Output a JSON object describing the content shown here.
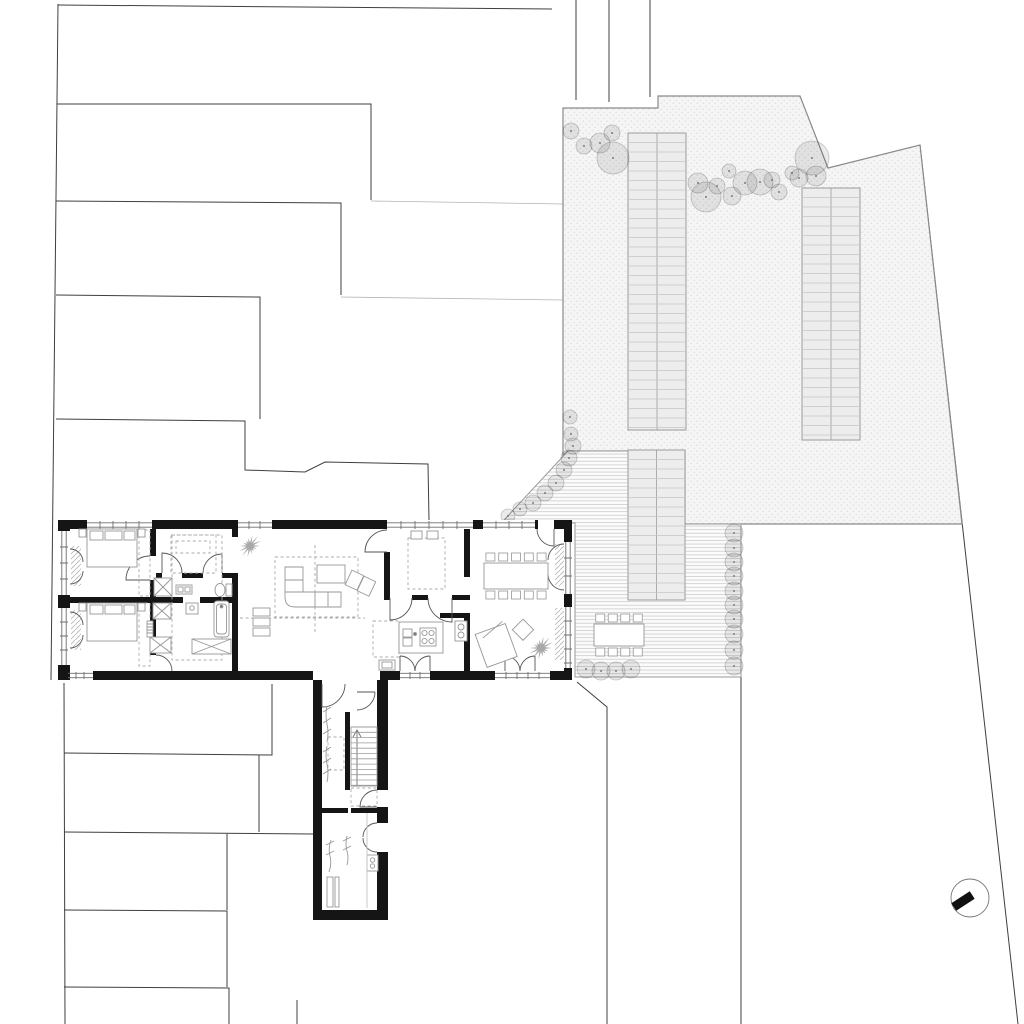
{
  "canvas": {
    "width": 1024,
    "height": 1024,
    "background": "#ffffff"
  },
  "palette": {
    "paper": "#ffffff",
    "wall": "#151515",
    "site_line": "#3f3f3f",
    "detail": "#979797",
    "dashed": "#ababab",
    "window": "#6e6e6e",
    "door": "#555555",
    "stipple_bg": "#f5f5f5",
    "stipple_dot": "#dadada",
    "deck_bg": "#fbfbfb",
    "deck_line": "#d2d2d2",
    "bed_fill": "#ededed",
    "bed_line": "#9b9b9b",
    "bed_rung": "#c4c4c4",
    "tree_fill": "rgba(0,0,0,0.08)",
    "tree_stroke": "rgba(0,0,0,0.22)",
    "tree_dot": "#7d7d7d",
    "plant": "#9a9a9a",
    "north": "#111111"
  },
  "site": {
    "lines": [
      [
        [
          58,
          4
        ],
        [
          51,
          680
        ]
      ],
      [
        [
          64,
          683
        ],
        [
          65,
          1024
        ]
      ],
      [
        [
          58,
          5
        ],
        [
          552,
          9
        ]
      ],
      [
        [
          576,
          0
        ],
        [
          576,
          100
        ]
      ],
      [
        [
          609,
          0
        ],
        [
          609,
          102
        ]
      ],
      [
        [
          650,
          0
        ],
        [
          650,
          97
        ]
      ],
      [
        [
          57,
          104
        ],
        [
          371,
          104
        ],
        [
          371,
          200
        ]
      ],
      [
        [
          56,
          201
        ],
        [
          341,
          203
        ],
        [
          341,
          295
        ]
      ],
      [
        [
          56,
          295
        ],
        [
          260,
          297
        ],
        [
          260,
          419
        ]
      ],
      [
        [
          56,
          419
        ],
        [
          245,
          421
        ],
        [
          245,
          470
        ],
        [
          305,
          472
        ],
        [
          325,
          462
        ],
        [
          428,
          464
        ],
        [
          429,
          520
        ]
      ],
      [
        [
          272,
          684
        ],
        [
          272,
          755
        ],
        [
          64,
          753
        ]
      ],
      [
        [
          259,
          755
        ],
        [
          259,
          832
        ]
      ],
      [
        [
          64,
          832
        ],
        [
          313,
          834
        ]
      ],
      [
        [
          227,
          834
        ],
        [
          227,
          910
        ]
      ],
      [
        [
          64,
          910
        ],
        [
          227,
          911
        ],
        [
          227,
          987
        ]
      ],
      [
        [
          64,
          987
        ],
        [
          229,
          988
        ],
        [
          229,
          1024
        ]
      ],
      [
        [
          297,
          1000
        ],
        [
          297,
          1024
        ]
      ],
      [
        [
          577,
          682
        ],
        [
          607,
          707
        ],
        [
          607,
          1024
        ]
      ],
      [
        [
          741,
          525
        ],
        [
          741,
          1024
        ]
      ],
      [
        [
          920,
          145
        ],
        [
          1018,
          1024
        ]
      ]
    ],
    "faint_lines": [
      [
        [
          371,
          201
        ],
        [
          563,
          204
        ]
      ],
      [
        [
          341,
          297
        ],
        [
          563,
          300
        ]
      ]
    ]
  },
  "garden": {
    "outline": [
      [
        563,
        455
      ],
      [
        563,
        108
      ],
      [
        658,
        108
      ],
      [
        658,
        96
      ],
      [
        800,
        96
      ],
      [
        828,
        168
      ],
      [
        920,
        145
      ],
      [
        962,
        524
      ],
      [
        741,
        524
      ],
      [
        685,
        524
      ],
      [
        685,
        451
      ],
      [
        568,
        451
      ]
    ],
    "beds": [
      {
        "x": 628,
        "y": 133,
        "w": 58,
        "h": 297
      },
      {
        "x": 802,
        "y": 188,
        "w": 58,
        "h": 252
      },
      {
        "x": 628,
        "y": 450,
        "w": 57,
        "h": 150
      }
    ],
    "rung_gap": 9.5,
    "trees": [
      [
        571,
        131,
        8
      ],
      [
        584,
        146,
        8
      ],
      [
        600,
        143,
        10
      ],
      [
        612,
        133,
        8
      ],
      [
        613,
        158,
        16
      ],
      [
        698,
        183,
        10
      ],
      [
        706,
        197,
        15
      ],
      [
        717,
        186,
        8
      ],
      [
        729,
        171,
        7
      ],
      [
        732,
        196,
        9
      ],
      [
        745,
        183,
        12
      ],
      [
        760,
        182,
        13
      ],
      [
        772,
        180,
        8
      ],
      [
        779,
        192,
        8
      ],
      [
        792,
        173,
        7
      ],
      [
        799,
        178,
        9
      ],
      [
        812,
        158,
        17
      ],
      [
        816,
        176,
        10
      ]
    ],
    "bushes": [
      [
        508,
        516,
        7
      ],
      [
        520,
        509,
        7
      ],
      [
        533,
        503,
        8
      ],
      [
        545,
        493,
        8
      ],
      [
        556,
        483,
        8
      ],
      [
        564,
        470,
        8
      ],
      [
        569,
        458,
        8
      ],
      [
        573,
        446,
        8
      ],
      [
        571,
        434,
        7
      ],
      [
        570,
        417,
        7
      ],
      [
        734,
        533,
        9
      ],
      [
        734,
        548,
        9
      ],
      [
        734,
        562,
        9
      ],
      [
        734,
        576,
        9
      ],
      [
        734,
        591,
        9
      ],
      [
        734,
        605,
        9
      ],
      [
        734,
        619,
        9
      ],
      [
        734,
        634,
        9
      ],
      [
        734,
        650,
        9
      ],
      [
        734,
        666,
        9
      ],
      [
        586,
        669,
        9
      ],
      [
        601,
        671,
        9
      ],
      [
        616,
        671,
        9
      ],
      [
        631,
        669,
        9
      ]
    ]
  },
  "terrace": {
    "outline": [
      [
        504,
        520
      ],
      [
        568,
        451
      ],
      [
        685,
        451
      ],
      [
        685,
        524
      ],
      [
        741,
        524
      ],
      [
        741,
        677
      ],
      [
        575,
        677
      ],
      [
        575,
        523
      ]
    ],
    "table": {
      "x": 594,
      "y": 624,
      "w": 50,
      "h": 22,
      "chairs_top": 4,
      "chairs_bottom": 4
    }
  },
  "house": {
    "dining_table": {
      "x": 484,
      "y": 563,
      "w": 64,
      "h": 26,
      "chairs_top": 5,
      "chairs_bottom": 5
    },
    "stairs": {
      "x": 351,
      "y": 727,
      "w": 26,
      "treads": 12,
      "gap": 5.3
    },
    "plants": [
      {
        "cx": 250,
        "cy": 546,
        "r": 13
      },
      {
        "cx": 541,
        "cy": 648,
        "r": 14
      }
    ]
  },
  "north_arrow": {
    "cx": 970,
    "cy": 898,
    "r": 19,
    "bar_cx": 963,
    "bar_cy": 901,
    "bar_w": 22,
    "bar_h": 9,
    "angle": -33
  }
}
